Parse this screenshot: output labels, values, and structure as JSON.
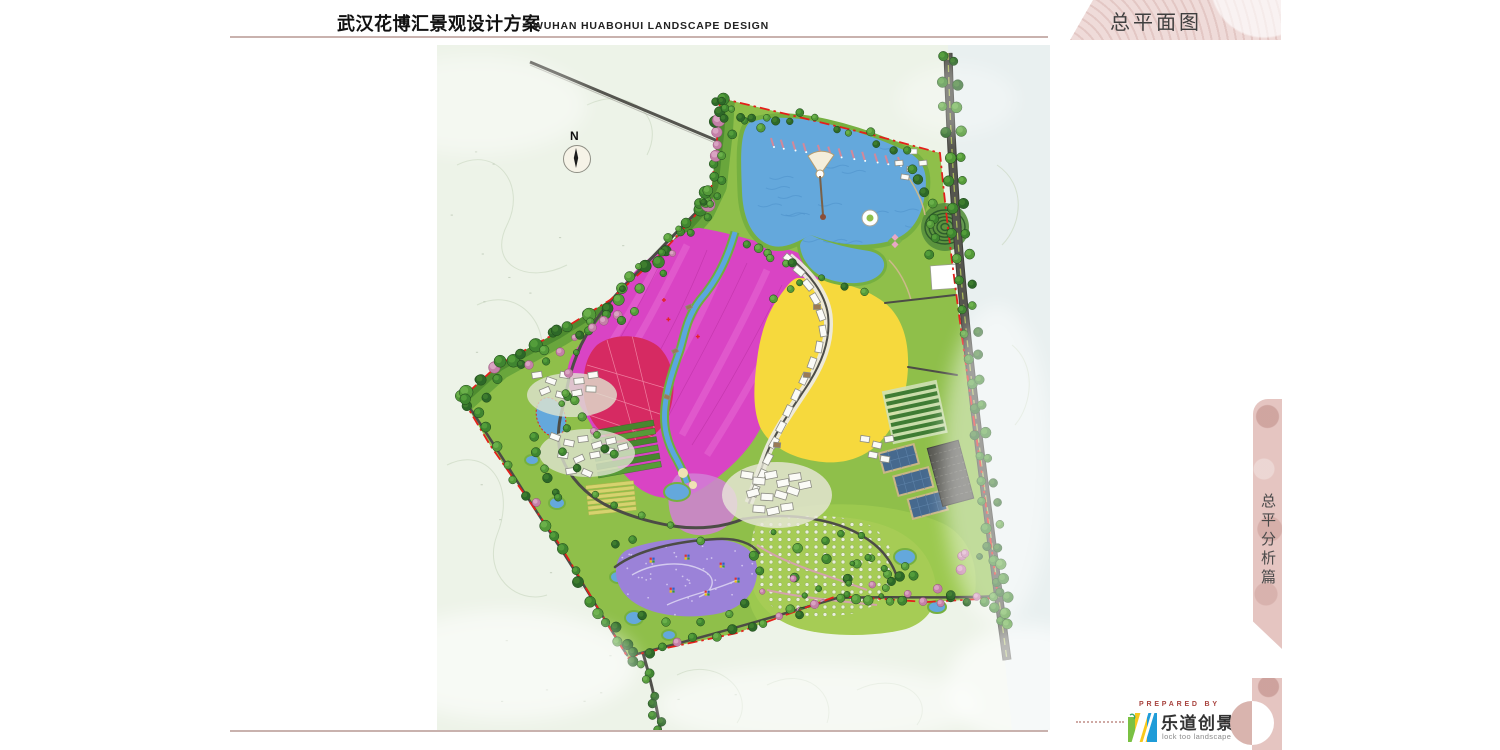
{
  "header": {
    "title_cn": "武汉花博汇景观设计方案",
    "title_en": "WUHAN  HUABOHUI  LANDSCAPE  DESIGN"
  },
  "corner_tab": {
    "label": "总平面图"
  },
  "side_tab": {
    "label": "总平分析篇"
  },
  "map": {
    "compass_label": "N"
  },
  "footer": {
    "prepared_by": "PREPARED BY",
    "logo_cn": "乐道创景",
    "logo_en": "lock too landscape"
  },
  "colors": {
    "rule_pink": "#c9b2ae",
    "banner_pink": "#efdbd9",
    "ribbon_pink": "#e5c5c1",
    "prepared_red": "#a8433e",
    "boundary_red": "#e3201b",
    "map_bg": "#edf3e8",
    "site_green": "#8fbf4a",
    "lake_blue": "#64a8dc",
    "flower_magenta": "#d944c4",
    "festival_yellow": "#f6d93d",
    "crimson_red": "#d62a62",
    "event_purple": "#9b82d8",
    "road_dark": "#4c4c46",
    "radial_line_green": "#93ab4c",
    "logo_green": "#7ac143",
    "logo_yellow": "#f8c81c",
    "logo_blue": "#1f9cd8"
  }
}
